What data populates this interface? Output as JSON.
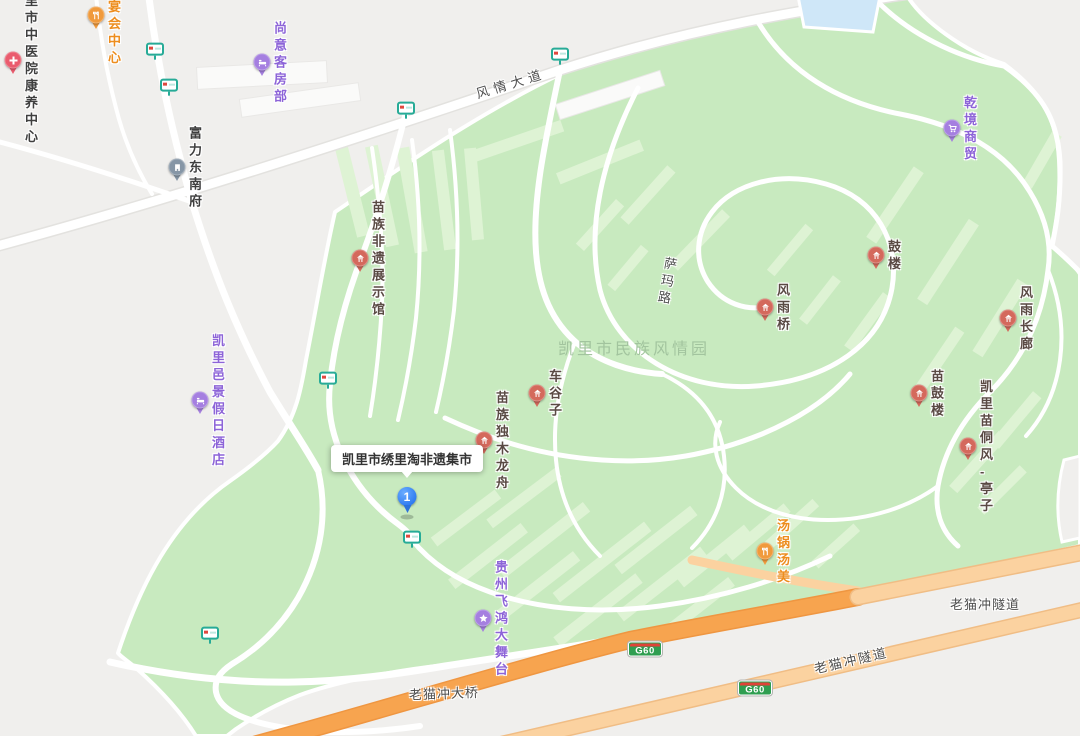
{
  "map": {
    "watermark": "凯里市民族风情园",
    "tooltip": {
      "text": "凯里市绣里淘非遗集市",
      "x": 407,
      "y": 478
    },
    "selected_marker": {
      "number": "1",
      "x": 407,
      "y": 514
    },
    "pois": [
      {
        "name": "jiayue-banquet-center",
        "label": "嘉悦宴会中心",
        "x": 96,
        "y": 15,
        "type": "food"
      },
      {
        "name": "kaili-tcm-hospital-care-center",
        "label": "凯里市中医院\n康养中心",
        "x": 13,
        "y": 60,
        "type": "medical"
      },
      {
        "name": "shangyi-guest-rooms",
        "label": "尚意客房部",
        "x": 262,
        "y": 62,
        "type": "lodging"
      },
      {
        "name": "fuli-dongnanfu",
        "label": "富力东南府",
        "x": 177,
        "y": 167,
        "type": "estate"
      },
      {
        "name": "qianjing-trading",
        "label": "乾境商贸",
        "x": 952,
        "y": 128,
        "type": "shopping"
      },
      {
        "name": "miao-heritage-exhibition-hall",
        "label": "苗族非遗展示馆",
        "x": 360,
        "y": 258,
        "type": "scenic"
      },
      {
        "name": "drum-tower",
        "label": "鼓楼",
        "x": 876,
        "y": 255,
        "type": "scenic"
      },
      {
        "name": "wind-rain-bridge",
        "label": "风雨桥",
        "x": 765,
        "y": 307,
        "type": "scenic"
      },
      {
        "name": "wind-rain-corridor",
        "label": "风雨长廊",
        "x": 1008,
        "y": 318,
        "type": "scenic"
      },
      {
        "name": "cheguzi",
        "label": "车谷子",
        "x": 537,
        "y": 393,
        "type": "scenic"
      },
      {
        "name": "miao-drum-tower",
        "label": "苗鼓楼",
        "x": 919,
        "y": 393,
        "type": "scenic"
      },
      {
        "name": "kaili-yijing-holiday-hotel",
        "label": "凯里邑景假日酒店",
        "x": 200,
        "y": 400,
        "type": "lodging"
      },
      {
        "name": "miao-dugout-canoe",
        "label": "苗族独木龙舟",
        "x": 484,
        "y": 440,
        "type": "scenic"
      },
      {
        "name": "kaili-miao-dong-pavilion",
        "label": "凯里苗侗风\n-亭子",
        "x": 968,
        "y": 446,
        "type": "scenic"
      },
      {
        "name": "tangguo-tangmei",
        "label": "汤锅汤美",
        "x": 765,
        "y": 551,
        "type": "food"
      },
      {
        "name": "guizhou-feihong-stage",
        "label": "贵州飞鸿大舞台",
        "x": 483,
        "y": 618,
        "type": "stage"
      }
    ],
    "road_labels": [
      {
        "name": "fengqing-avenue",
        "text": "风情大道",
        "x": 511,
        "y": 84,
        "rotate": -17,
        "vertical": false,
        "spacing": 5
      },
      {
        "name": "sama-road",
        "text": "萨玛路",
        "x": 666,
        "y": 282,
        "rotate": 10,
        "vertical": true,
        "spacing": 4
      },
      {
        "name": "laomaochong-tunnel-east",
        "text": "老猫冲隧道",
        "x": 985,
        "y": 605,
        "rotate": 0,
        "vertical": false,
        "spacing": 1
      },
      {
        "name": "laomaochong-tunnel-west",
        "text": "老猫冲隧道",
        "x": 851,
        "y": 661,
        "rotate": -13,
        "vertical": false,
        "spacing": 2
      },
      {
        "name": "laomaochong-bridge",
        "text": "老猫冲大桥",
        "x": 444,
        "y": 694,
        "rotate": -2,
        "vertical": false,
        "spacing": 1
      }
    ],
    "highway_badges": [
      {
        "text": "G60",
        "x": 645,
        "y": 649
      },
      {
        "text": "G60",
        "x": 755,
        "y": 688
      }
    ],
    "bus_stops": [
      [
        155,
        52
      ],
      [
        169,
        88
      ],
      [
        560,
        57
      ],
      [
        406,
        111
      ],
      [
        328,
        381
      ],
      [
        412,
        540
      ],
      [
        210,
        636
      ]
    ],
    "colors": {
      "park": "#c8eabf",
      "park_light": "#def3d4",
      "urban": "#f0efed",
      "water": "#cfe7f8",
      "road": "#ffffff",
      "expressway": "#f7a44f",
      "expressway_tunnel": "#fbd2a0",
      "marker_blue": "#3d86f2",
      "scenic_pin": "#d4695c",
      "food_pin": "#f09a3c",
      "purple_pin": "#a57fe0",
      "medical_pin": "#ea5c6e",
      "estate_pin": "#8696a6",
      "bus_stop_teal": "#27ab97",
      "scenic_text": "#5a4a44",
      "food_text": "#ed8d1e",
      "purple_text": "#8d64d8",
      "dark_text": "#3f3f3f"
    }
  }
}
